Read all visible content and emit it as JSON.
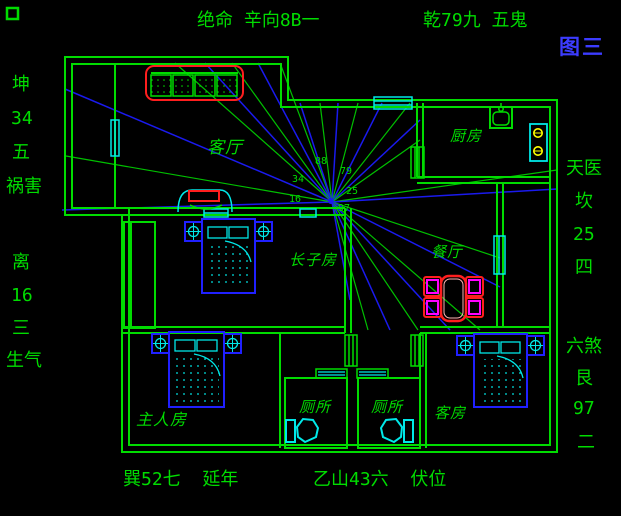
{
  "figure": {
    "tag": "图三"
  },
  "compass": {
    "top_label": "绝命 辛向8B一",
    "top_right_label": "乾79九 五鬼",
    "bottom_left_label": "巽52七  延年",
    "bottom_right_label": "乙山43六  伏位",
    "left_top": [
      "坤",
      "34",
      "五",
      "祸害"
    ],
    "left_bottom": [
      "离",
      "16",
      "三",
      "生气"
    ],
    "right_top": [
      "天医",
      "坎",
      "25",
      "四"
    ],
    "right_bottom": [
      "六煞",
      "艮",
      "97",
      "二"
    ]
  },
  "rooms": [
    {
      "label": "客厅"
    },
    {
      "label": "厨房"
    },
    {
      "label": "餐厅"
    },
    {
      "label": "长子房"
    },
    {
      "label": "主人房"
    },
    {
      "label": "厕所"
    },
    {
      "label": "厕所"
    },
    {
      "label": "客房"
    }
  ],
  "center_numbers": [
    {
      "value": "88",
      "x": 315,
      "y": 157
    },
    {
      "value": "79",
      "x": 340,
      "y": 167
    },
    {
      "value": "34",
      "x": 292,
      "y": 175
    },
    {
      "value": "25",
      "x": 346,
      "y": 187
    },
    {
      "value": "16",
      "x": 289,
      "y": 195
    },
    {
      "value": "97",
      "x": 338,
      "y": 204
    }
  ],
  "rays": {
    "center": {
      "x": 332,
      "y": 202
    },
    "lines": [
      {
        "x": 62,
        "y": 210,
        "c": "b"
      },
      {
        "x": 66,
        "y": 156,
        "c": "g"
      },
      {
        "x": 65,
        "y": 89,
        "c": "b"
      },
      {
        "x": 175,
        "y": 63,
        "c": "g"
      },
      {
        "x": 205,
        "y": 63,
        "c": "b"
      },
      {
        "x": 232,
        "y": 63,
        "c": "g"
      },
      {
        "x": 258,
        "y": 63,
        "c": "b"
      },
      {
        "x": 280,
        "y": 63,
        "c": "g"
      },
      {
        "x": 300,
        "y": 103,
        "c": "b"
      },
      {
        "x": 320,
        "y": 103,
        "c": "g"
      },
      {
        "x": 338,
        "y": 103,
        "c": "b"
      },
      {
        "x": 358,
        "y": 103,
        "c": "g"
      },
      {
        "x": 382,
        "y": 103,
        "c": "b"
      },
      {
        "x": 410,
        "y": 103,
        "c": "g"
      },
      {
        "x": 420,
        "y": 120,
        "c": "b"
      },
      {
        "x": 420,
        "y": 140,
        "c": "g"
      },
      {
        "x": 557,
        "y": 170,
        "c": "g"
      },
      {
        "x": 557,
        "y": 189,
        "c": "b"
      },
      {
        "x": 500,
        "y": 258,
        "c": "g"
      },
      {
        "x": 500,
        "y": 287,
        "c": "b"
      },
      {
        "x": 480,
        "y": 330,
        "c": "g"
      },
      {
        "x": 450,
        "y": 330,
        "c": "b"
      },
      {
        "x": 418,
        "y": 330,
        "c": "g"
      },
      {
        "x": 390,
        "y": 330,
        "c": "b"
      },
      {
        "x": 368,
        "y": 330,
        "c": "g"
      },
      {
        "x": 350,
        "y": 300,
        "c": "b"
      }
    ]
  },
  "colors": {
    "wall": "#00DC00",
    "ray_green": "#00C000",
    "ray_blue": "#1A1AEE",
    "text_green": "#00DC00",
    "figure_blue": "#3C3CFF",
    "red": "#FF1E1E",
    "cyan": "#00E8E8",
    "blue_furniture": "#2020FF",
    "yellow": "#FFFF00",
    "magenta": "#FF00FF"
  }
}
